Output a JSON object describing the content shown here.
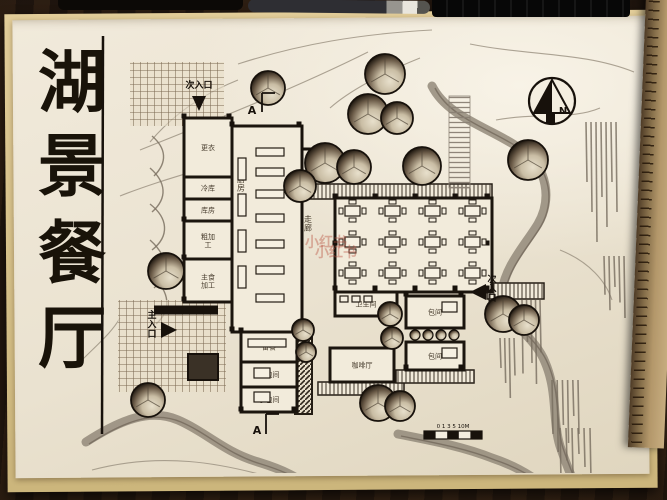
{
  "title": {
    "text": "湖景餐厅",
    "chars": [
      "湖",
      "景",
      "餐",
      "厅"
    ],
    "x": 72,
    "ys": [
      106,
      190,
      277,
      362
    ],
    "size": 68,
    "line": {
      "x": 103,
      "y1": 36,
      "y2": 434
    }
  },
  "watermark": {
    "text": "小红书",
    "color": "rgba(186,84,66,0.42)",
    "positions": [
      [
        326,
        247
      ],
      [
        336,
        257
      ]
    ],
    "size": 14
  },
  "plan": {
    "wall_color": "#1b150e",
    "room_fill": "#f2ebdb",
    "ink": "#17110b",
    "rooms": [
      {
        "name": "room-changing",
        "label": "更衣",
        "x": 184,
        "y": 118,
        "w": 48,
        "h": 59
      },
      {
        "name": "room-cold-store",
        "label": "冷库",
        "x": 184,
        "y": 177,
        "w": 48,
        "h": 22
      },
      {
        "name": "room-storage",
        "label": "库房",
        "x": 184,
        "y": 199,
        "w": 48,
        "h": 22
      },
      {
        "name": "room-rough-prep",
        "label": "粗加工",
        "x": 184,
        "y": 221,
        "w": 48,
        "h": 38,
        "wrap": true
      },
      {
        "name": "room-staple-prep",
        "label": "主食加工",
        "x": 184,
        "y": 259,
        "w": 48,
        "h": 43,
        "wrap": true
      },
      {
        "name": "room-kitchen",
        "label": "厨房",
        "x": 232,
        "y": 126,
        "w": 70,
        "h": 206,
        "vertical": true,
        "lx": 241,
        "ly": 182
      },
      {
        "name": "dining-hall",
        "label": "",
        "x": 335,
        "y": 198,
        "w": 157,
        "h": 94
      },
      {
        "name": "room-pantry",
        "label": "备餐",
        "x": 241,
        "y": 332,
        "w": 56,
        "h": 30
      },
      {
        "name": "room-private-small-1",
        "label": "小包间",
        "x": 241,
        "y": 362,
        "w": 56,
        "h": 25
      },
      {
        "name": "room-private-small-2",
        "label": "小包间",
        "x": 241,
        "y": 387,
        "w": 56,
        "h": 25
      },
      {
        "name": "room-washroom",
        "label": "卫生间",
        "x": 335,
        "y": 292,
        "w": 62,
        "h": 24
      },
      {
        "name": "room-cafe",
        "label": "咖啡厅",
        "x": 330,
        "y": 348,
        "w": 64,
        "h": 34
      },
      {
        "name": "room-private-1",
        "label": "包间",
        "x": 406,
        "y": 296,
        "w": 58,
        "h": 32
      },
      {
        "name": "room-private-2",
        "label": "包间",
        "x": 406,
        "y": 342,
        "w": 58,
        "h": 28
      }
    ],
    "labels": [
      {
        "name": "label-corridor",
        "text": "走廊",
        "x": 308,
        "y": 222,
        "vertical": true,
        "size": 8
      }
    ],
    "decks": [
      {
        "name": "veranda-north",
        "x": 287,
        "y": 184,
        "w": 205,
        "h": 15,
        "dir": "v"
      },
      {
        "name": "shelf-north",
        "x": 234,
        "y": 128,
        "w": 66,
        "h": 12,
        "dir": "v"
      },
      {
        "name": "deck-east",
        "x": 475,
        "y": 199,
        "w": 17,
        "h": 92,
        "dir": "h"
      },
      {
        "name": "bridge-east",
        "x": 487,
        "y": 283,
        "w": 57,
        "h": 16,
        "dir": "v"
      },
      {
        "name": "steps-north",
        "x": 449,
        "y": 96,
        "w": 21,
        "h": 92,
        "dir": "h",
        "gray": true
      },
      {
        "name": "deck-cafe",
        "x": 318,
        "y": 382,
        "w": 86,
        "h": 13,
        "dir": "v"
      },
      {
        "name": "deck-private",
        "x": 396,
        "y": 370,
        "w": 78,
        "h": 13,
        "dir": "v"
      },
      {
        "name": "planter-strip",
        "x": 295,
        "y": 324,
        "w": 17,
        "h": 90,
        "dir": "d"
      }
    ],
    "grids": [
      {
        "name": "pergola-plaza",
        "x": 130,
        "y": 62,
        "w": 94,
        "h": 64
      },
      {
        "name": "entry-plaza",
        "x": 118,
        "y": 300,
        "w": 108,
        "h": 92
      }
    ],
    "segments": [
      {
        "x1": 154,
        "y1": 310,
        "x2": 218,
        "y2": 310,
        "w": 9
      },
      {
        "x1": 302,
        "y1": 149,
        "x2": 335,
        "y2": 149,
        "w": 3
      },
      {
        "x1": 302,
        "y1": 126,
        "x2": 302,
        "y2": 332,
        "w": 3
      }
    ],
    "planter_box": {
      "x": 188,
      "y": 354,
      "w": 30,
      "h": 26
    },
    "columns": [
      [
        335,
        196
      ],
      [
        375,
        196
      ],
      [
        415,
        196
      ],
      [
        455,
        196
      ],
      [
        487,
        196
      ],
      [
        335,
        243
      ],
      [
        335,
        288
      ],
      [
        375,
        288
      ],
      [
        415,
        288
      ],
      [
        455,
        288
      ],
      [
        487,
        288
      ],
      [
        487,
        243
      ],
      [
        232,
        124
      ],
      [
        299,
        124
      ],
      [
        232,
        329
      ],
      [
        299,
        329
      ],
      [
        184,
        116
      ],
      [
        229,
        116
      ],
      [
        184,
        299
      ],
      [
        241,
        330
      ],
      [
        294,
        330
      ],
      [
        241,
        409
      ],
      [
        294,
        409
      ],
      [
        406,
        294
      ],
      [
        461,
        294
      ],
      [
        406,
        367
      ],
      [
        461,
        367
      ],
      [
        184,
        219
      ],
      [
        184,
        257
      ]
    ],
    "tables": {
      "cols": [
        345,
        385,
        425,
        465
      ],
      "rows": [
        206,
        237,
        268
      ]
    },
    "counters": [
      [
        238,
        158,
        8,
        22
      ],
      [
        238,
        194,
        8,
        22
      ],
      [
        238,
        230,
        8,
        22
      ],
      [
        238,
        266,
        8,
        22
      ],
      [
        256,
        148,
        28,
        8
      ],
      [
        256,
        168,
        28,
        8
      ],
      [
        256,
        190,
        28,
        8
      ],
      [
        256,
        214,
        28,
        8
      ],
      [
        256,
        240,
        28,
        8
      ],
      [
        256,
        266,
        28,
        8
      ],
      [
        256,
        294,
        28,
        8
      ],
      [
        248,
        339,
        38,
        8
      ],
      [
        254,
        368,
        16,
        10
      ],
      [
        254,
        392,
        16,
        10
      ],
      [
        442,
        302,
        15,
        10
      ],
      [
        442,
        348,
        15,
        10
      ],
      [
        340,
        296,
        8,
        6
      ],
      [
        352,
        296,
        8,
        6
      ],
      [
        364,
        296,
        8,
        6
      ]
    ],
    "trees": [
      [
        268,
        88,
        17
      ],
      [
        385,
        74,
        20
      ],
      [
        368,
        114,
        20
      ],
      [
        397,
        118,
        16
      ],
      [
        325,
        163,
        20
      ],
      [
        354,
        167,
        17
      ],
      [
        422,
        166,
        19
      ],
      [
        300,
        186,
        16
      ],
      [
        528,
        160,
        20
      ],
      [
        166,
        271,
        18
      ],
      [
        148,
        400,
        17
      ],
      [
        378,
        403,
        18
      ],
      [
        400,
        406,
        15
      ],
      [
        503,
        314,
        18
      ],
      [
        524,
        320,
        15
      ],
      [
        390,
        314,
        12
      ],
      [
        392,
        338,
        11
      ],
      [
        303,
        330,
        11
      ],
      [
        306,
        352,
        10
      ]
    ],
    "bushes": [
      [
        415,
        335,
        5
      ],
      [
        428,
        335,
        5
      ],
      [
        441,
        335,
        5
      ],
      [
        454,
        335,
        5
      ]
    ],
    "streams": [
      "M432,86 C448,118 492,128 522,150 C548,168 552,200 538,224 C526,244 505,266 502,292 C499,318 534,334 545,362 C558,392 552,420 560,446 C566,464 572,478 578,492",
      "M86,442 C120,420 150,408 178,420 C206,432 224,452 258,462 C284,470 300,478 312,490",
      "M398,434 C428,440 462,446 492,458 C516,466 532,476 544,486"
    ],
    "contours": [
      "M140,150 C220,118 300,86 368,52",
      "M238,64 C300,44 360,34 432,30",
      "M470,44 C530,56 584,52 634,72",
      "M120,196 C170,176 220,166 262,148",
      "M496,120 C540,112 572,120 600,108",
      "M560,250 C590,262 606,282 612,300",
      "M80,362 C100,342 112,332 120,318",
      "M92,470 C160,452 220,462 280,480",
      "M238,80 C198,96 170,118 150,142",
      "M420,58 C380,74 348,92 330,108"
    ],
    "scribbles": [
      "M152,136 C166,148 168,162 154,176",
      "M150,168 C166,182 168,198 152,212",
      "M150,204 C168,218 170,236 152,250",
      "M150,240 C168,256 170,274 154,288",
      "M152,276 C170,292 172,310 156,324"
    ],
    "reeds": [
      {
        "x": 586,
        "y": 122,
        "w": 30,
        "h": 120,
        "n": 7
      },
      {
        "x": 604,
        "y": 256,
        "w": 20,
        "h": 62,
        "n": 5
      },
      {
        "x": 552,
        "y": 380,
        "w": 26,
        "h": 72,
        "n": 6
      },
      {
        "x": 522,
        "y": 300,
        "w": 18,
        "h": 84,
        "n": 5
      },
      {
        "x": 560,
        "y": 428,
        "w": 30,
        "h": 52,
        "n": 6
      },
      {
        "x": 500,
        "y": 338,
        "w": 14,
        "h": 60,
        "n": 4
      }
    ],
    "entrances": [
      {
        "label": "次入口",
        "x": 199,
        "y": 88,
        "vertical": false,
        "arrow": [
          [
            192,
            96
          ],
          [
            206,
            96
          ],
          [
            199,
            111
          ]
        ]
      },
      {
        "label": "主入口",
        "x": 152,
        "y": 318,
        "vertical": true,
        "arrow": [
          [
            161,
            322
          ],
          [
            161,
            338
          ],
          [
            177,
            330
          ]
        ]
      },
      {
        "label": "次入口",
        "x": 492,
        "y": 282,
        "vertical": true,
        "arrow": [
          [
            486,
            284
          ],
          [
            486,
            300
          ],
          [
            470,
            292
          ]
        ]
      }
    ],
    "sections": [
      {
        "label": "A",
        "x": 252,
        "y": 114,
        "bracket": "M262,93 L262,112 M262,93 L275,93"
      },
      {
        "label": "A",
        "x": 257,
        "y": 434,
        "bracket": "M266,414 L266,434 M266,414 L279,414"
      }
    ],
    "north": {
      "label": "N",
      "cx": 552,
      "cy": 101,
      "r": 23
    },
    "scale_bar": {
      "label": "0 1 3 5 10M",
      "x": 424,
      "y": 431,
      "w": 58,
      "h": 8,
      "cells": 5
    }
  }
}
